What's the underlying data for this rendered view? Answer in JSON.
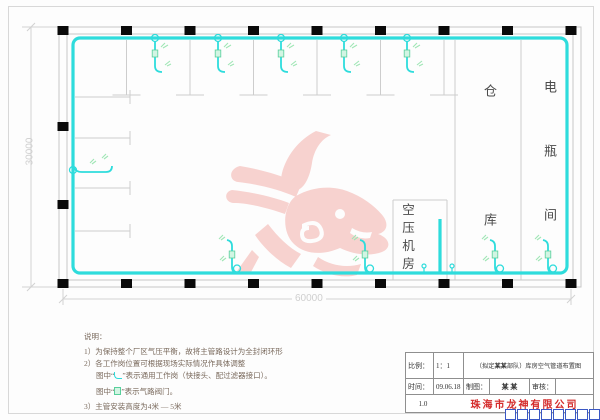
{
  "drawing": {
    "dim_vertical": "30000",
    "dim_horizontal": "60000",
    "rooms": {
      "warehouse": "仓库",
      "battery": "电瓶间",
      "compressor": "空压机房"
    }
  },
  "notes": {
    "heading": "说明：",
    "line1": "1）为保持整个厂区气压平衡，故将主管路设计为全封闭环形",
    "line2": "2）各工作岗位置可根据现场实际情况作具体调整",
    "line3_pre": "图中“",
    "line3_post": "”表示通用工作岗（快接头、配过滤器接口）。",
    "line4_pre": "图中“",
    "line4_post": "”表示气路阀门。",
    "line5": "3）主管安装高度为4米 — 5米"
  },
  "title_block": {
    "scale_label": "比例：",
    "scale_value": "1：1",
    "project_pre": "（拟定 ",
    "project_bold": "某某",
    "project_post": " 部队）库房空气管道布置图",
    "date_label": "时间：",
    "date_value": "09.06.18",
    "drafter_label": "制图：",
    "drafter_value": "某 某",
    "reviewer_label": "审核：",
    "reviewer_value": "",
    "version": "1.0",
    "company": "珠海市龙神有限公司"
  },
  "colors": {
    "pipe": "#2edcdc",
    "valve": "#58cf9b",
    "marks": "#9fe6b5",
    "watermark": "#f7cbc8",
    "company_red": "#d42a2a",
    "grip_blue": "#3a57c4"
  },
  "plan": {
    "top_drop_x": [
      155,
      218,
      281,
      344,
      407
    ],
    "bottom_drop_x": [
      232,
      365,
      495,
      548
    ],
    "column_x": [
      63,
      126.5,
      190,
      253.5,
      317,
      380.5,
      444,
      507.5,
      571
    ],
    "left_column_y": [
      126.5,
      204.5
    ]
  }
}
